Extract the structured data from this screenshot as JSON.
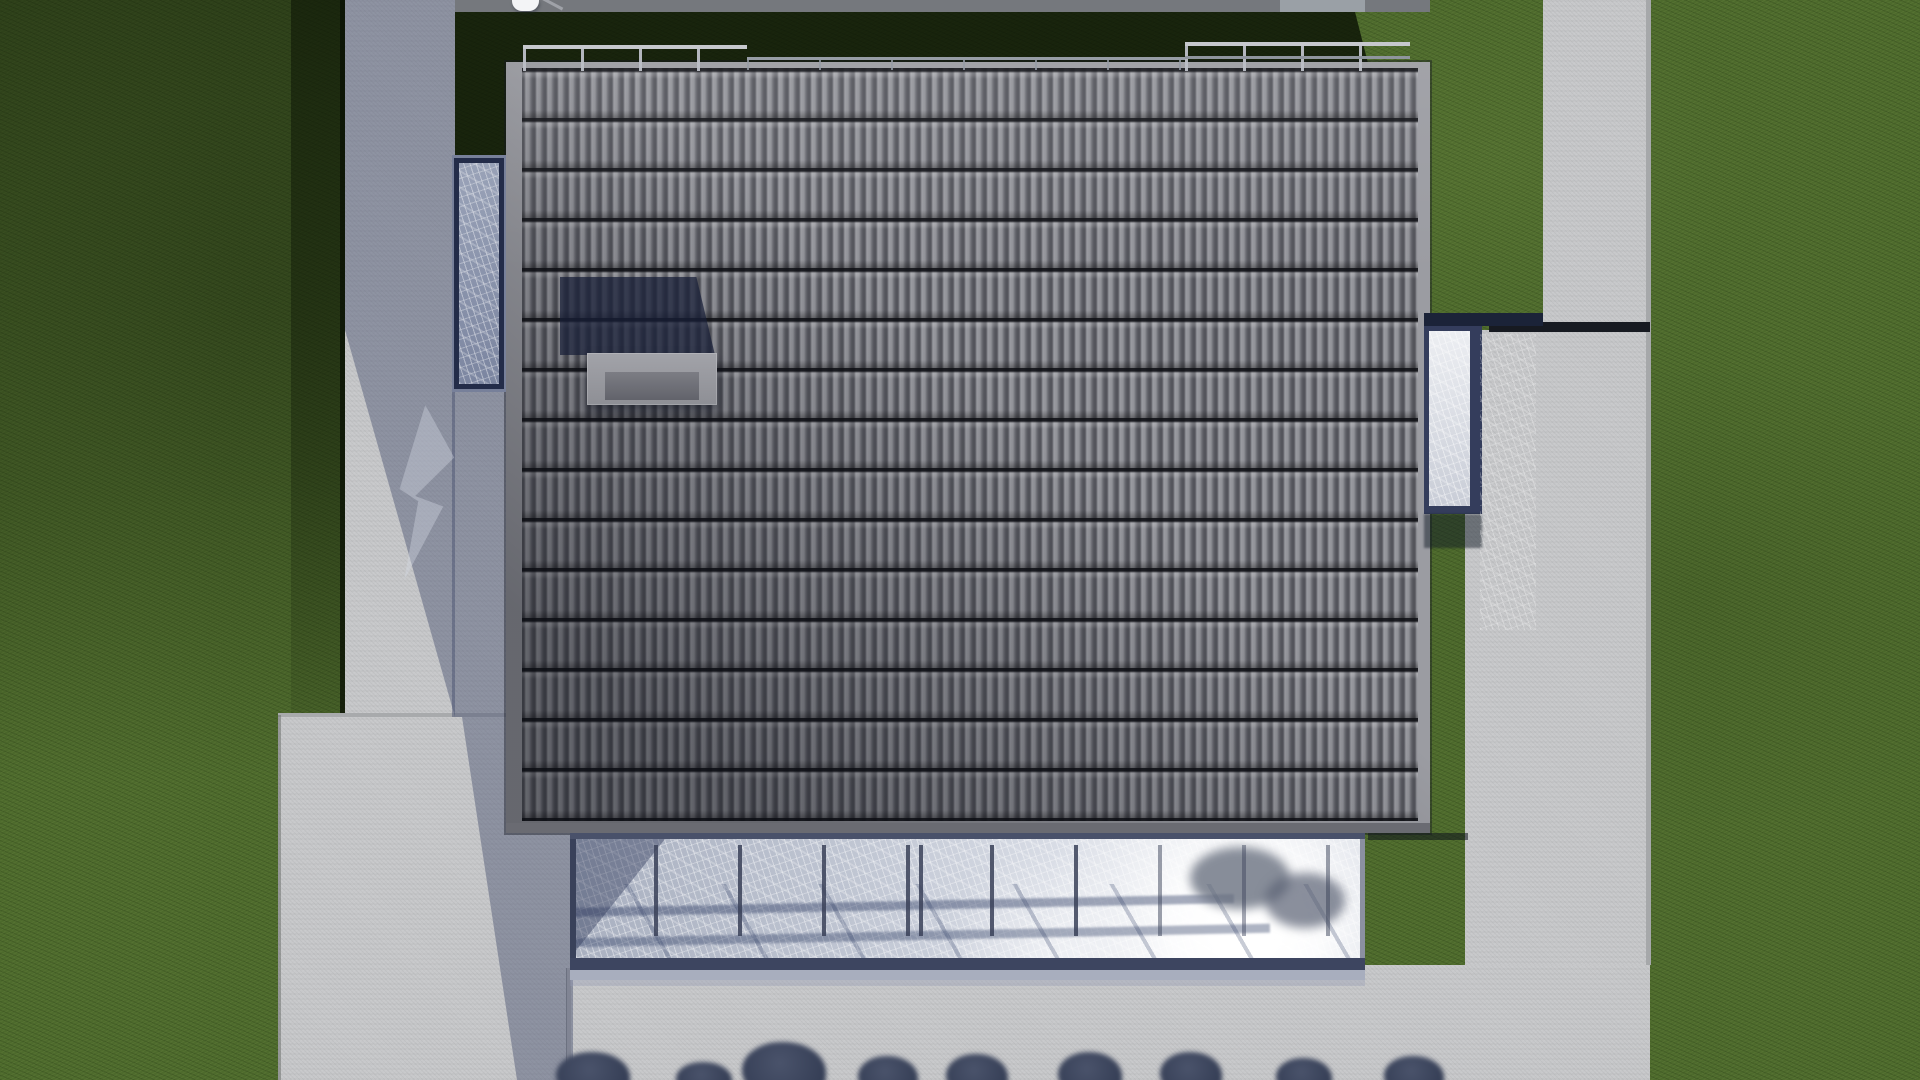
{
  "scene": {
    "description": "Top-down aerial 3D architectural rendering of a modern single-family house",
    "view": "orthographic top-down",
    "lighting": "low sun from lower right casting long shadows toward the upper left",
    "elements": {
      "roof": "large rectangular dark-gray tiled roof with light fascia border",
      "rooftop_railings": "three thin metal railing segments along the top roof edge",
      "skylight_box": "small hipped skylight box on the roof casting a navy shadow",
      "left_glass_canopy": "narrow glass skylight with dark navy frame on the left side",
      "right_glass_canopy": "narrow glass canopy with dark navy frame on the right side",
      "conservatory": "wide glass winter-garden roof along the bottom facade with mullions, tree reflections and a bright sun glare",
      "paths": "light concrete paths and patio framing the house",
      "grass": "green lawn fields with shadowed areas",
      "tree_silhouettes": "blurred dark tree tops along the bottom edge"
    },
    "counts": {
      "rooftop_railing_segments": 3,
      "conservatory_mullions": 10,
      "bottom_tree_silhouettes": 9
    }
  },
  "palette": {
    "grass": "#4d6a2c",
    "grass-shadow": "#1a2a0f",
    "concrete": "#c7c8ca",
    "concrete-shadow": "rgba(62,72,104,0.42)",
    "band-gray": "#75787d",
    "fascia": "#9b9ca2",
    "tile": "#87888e",
    "navy-frame": "#232c49",
    "skylight-shadow": "rgba(23,31,55,0.72)",
    "mullion": "#3a4158",
    "railing": "#c6c8cd",
    "railing-dim": "#979da6",
    "seam-dark": "#171a21",
    "tree": "#2e374e",
    "glow": "#ffffff"
  }
}
